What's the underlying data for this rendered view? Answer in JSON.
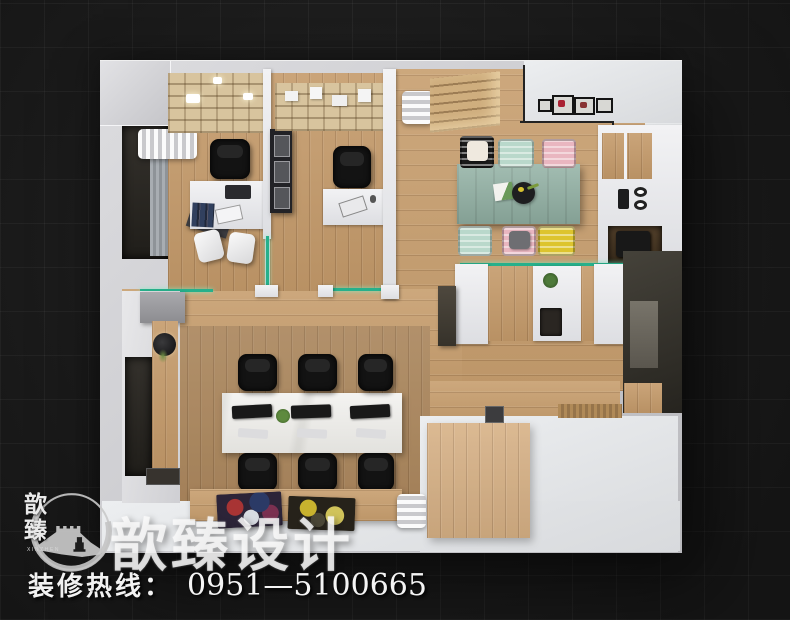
{
  "page": {
    "background_color": "#1d1d1d",
    "tile_size_px": 44,
    "description": "Top-down 3D interior render of an office floor plan on dark tiled backdrop"
  },
  "brand": {
    "watermark_text": "歆臻设计",
    "logo": {
      "vertical_text": "歆臻",
      "subtext": "XINZHEN",
      "symbol": "great-wall-in-circle"
    }
  },
  "hotline": {
    "label": "装修热线：",
    "number": "0951—5100665"
  },
  "palette": {
    "wall": "#cdced2",
    "wood_floor": "#c49a6a",
    "white_floor": "#e4e4e6",
    "teal_table": "#93b2a5",
    "glass_partition": "#27b08b",
    "chair_black": "#141414",
    "chair_mint": "#b9d8cb",
    "chair_pink": "#e9b6c0",
    "chair_yellow": "#ddc42e",
    "marble_worktable": "#ecebe7"
  },
  "floorplan": {
    "rooms": [
      "private-office-1",
      "private-office-2",
      "meeting-dining-area",
      "kitchenette",
      "reception-counter",
      "open-workstation-area",
      "entry-area"
    ],
    "meeting_chair_colors": [
      "black-white-cushion",
      "mint",
      "pink",
      "mint",
      "pink-gray-cushion",
      "yellow"
    ],
    "workstation": {
      "chairs": 6,
      "monitors": 3
    },
    "private_office_chairs": 2,
    "guest_chairs": 2,
    "wall_frames_top_right": 4
  }
}
